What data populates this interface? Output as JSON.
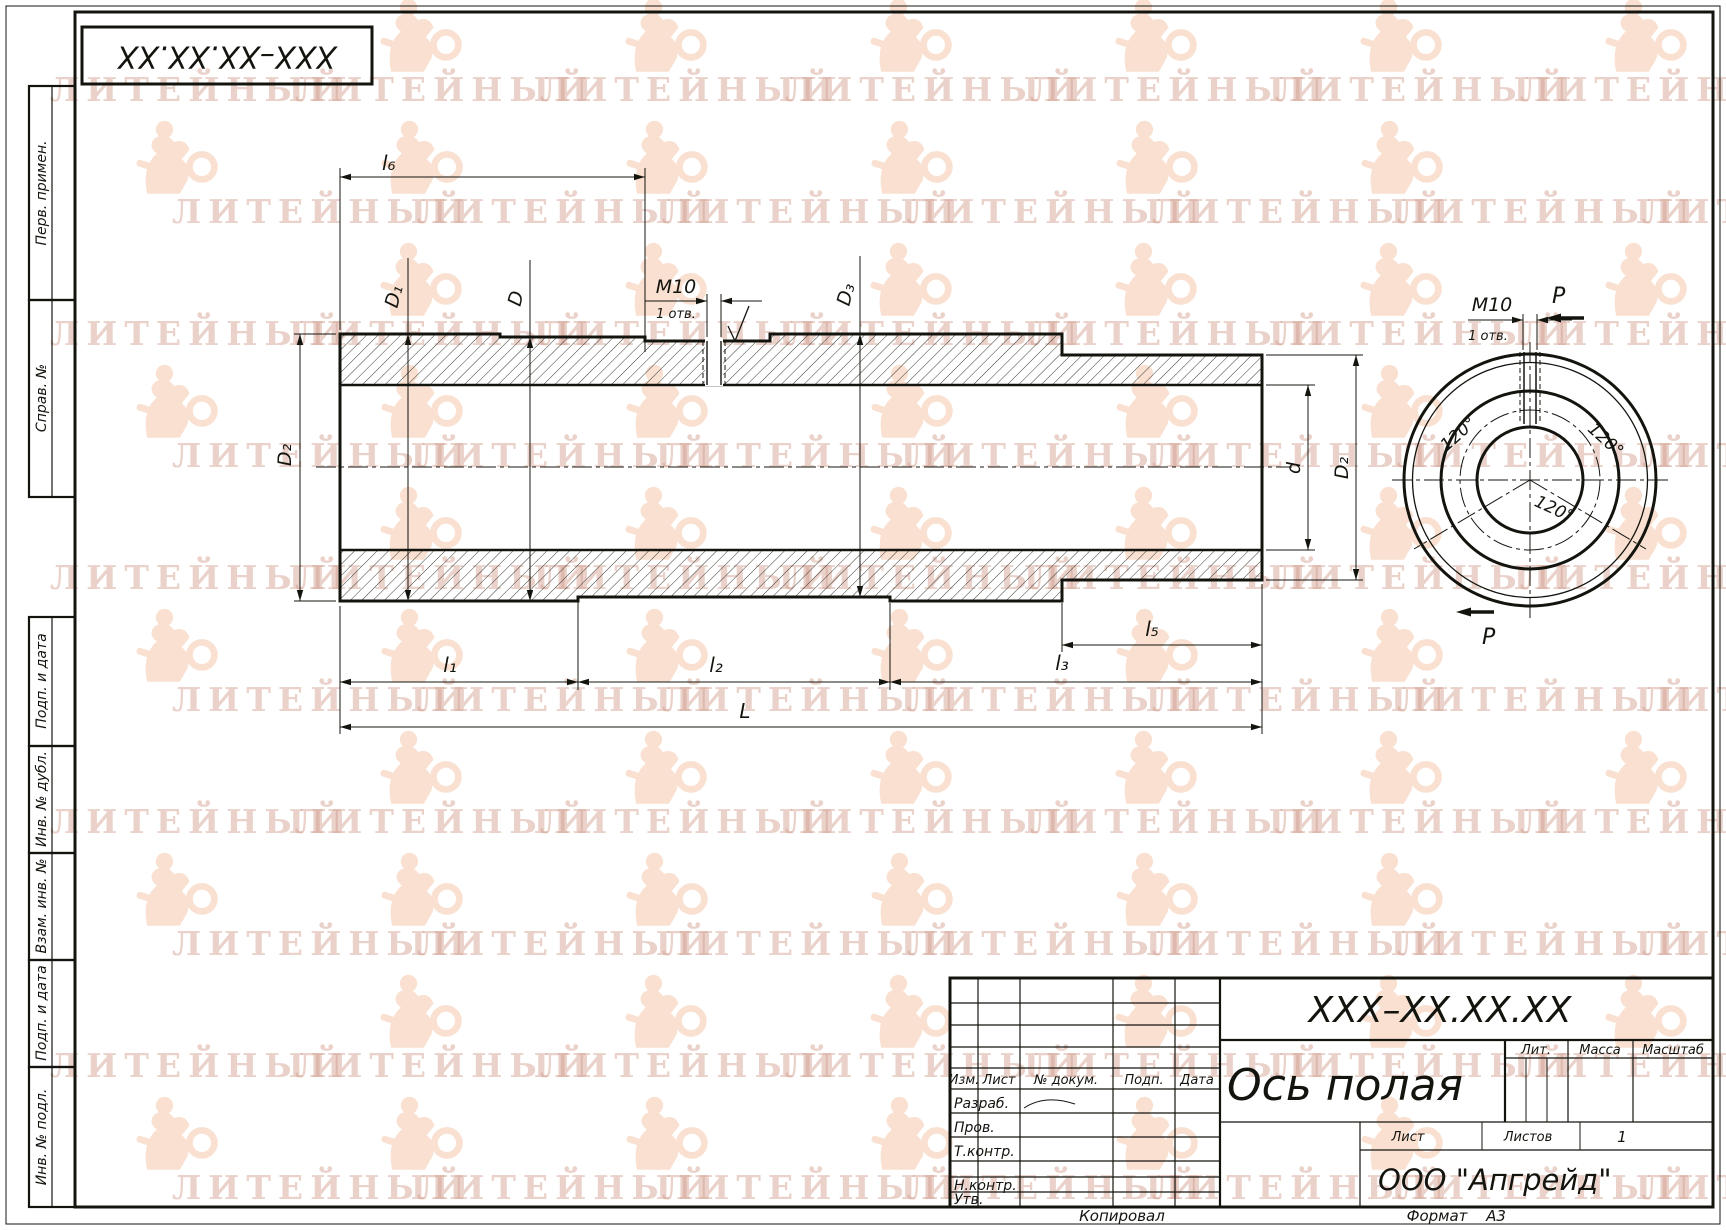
{
  "watermark": {
    "text": "ЛИТЕЙНЫЙ"
  },
  "stamp_margin": {
    "items": [
      {
        "label": "Перв. примен."
      },
      {
        "label": "Справ. №"
      },
      {
        "label": "Подп. и дата"
      },
      {
        "label": "Инв. № дубл."
      },
      {
        "label": "Взам. инв. №"
      },
      {
        "label": "Подп. и дата"
      },
      {
        "label": "Инв. № подл."
      }
    ]
  },
  "drawing": {
    "dims": {
      "l1": "l₁",
      "l2": "l₂",
      "l3": "l₃",
      "l5": "l₅",
      "l6": "l₆",
      "L": "L",
      "D1": "D₁",
      "D": "D",
      "D3": "D₃",
      "D2": "D₂",
      "d": "d",
      "thread": "M10",
      "thread_note": "1 отв.",
      "angle": "120°",
      "section": "P"
    }
  },
  "title_block": {
    "designation": "XXX–XX.XX.XX",
    "part_name": "Ось полая",
    "company": "ООО \"Апгрейд\"",
    "headers": {
      "lit": "Лит.",
      "mass": "Масса",
      "scale": "Масштаб",
      "sheet": "Лист",
      "sheets": "Листов",
      "sheets_value": "1"
    },
    "columns": {
      "izm": "Изм.",
      "list": "Лист",
      "doc": "№ докум.",
      "sign": "Подп.",
      "date": "Дата"
    },
    "rows": {
      "developed": "Разраб.",
      "checked": "Пров.",
      "tcontrol": "Т.контр.",
      "ncontrol": "Н.контр.",
      "approved": "Утв."
    }
  },
  "footer": {
    "copied": "Копировал",
    "format_label": "Формат",
    "format_value": "А3"
  }
}
